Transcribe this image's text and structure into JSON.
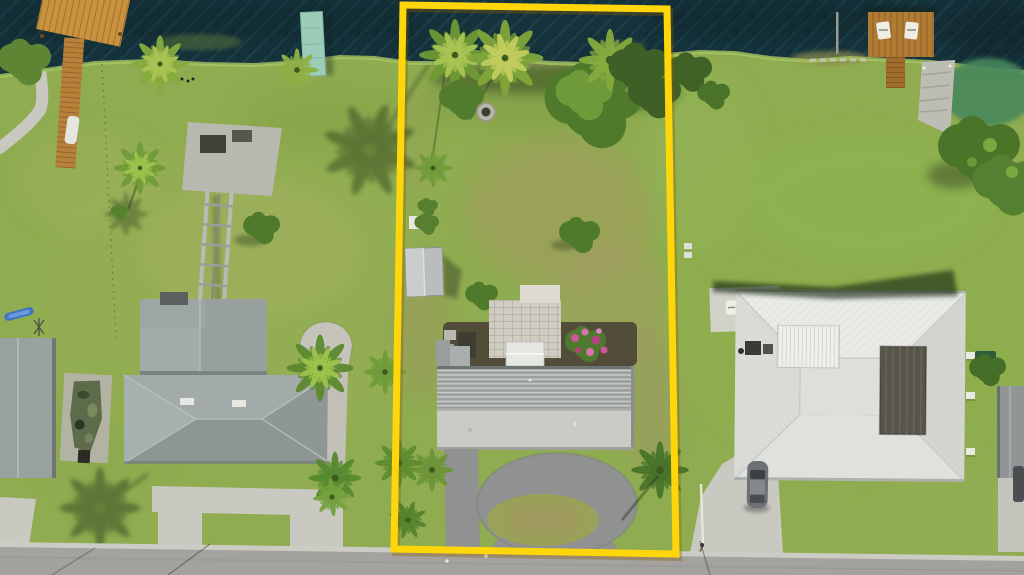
{
  "scene": {
    "kind": "aerial-drone-photograph",
    "subject": "waterfront-lot-with-yellow-property-outline",
    "water_edge": "canal across top",
    "street_edge": "asphalt road across bottom"
  },
  "colors": {
    "lot_outline": "#FFD60A",
    "lot_outline_shadow": "#8A5C00",
    "water": "#16333C",
    "grass_base": "#8FAC50",
    "road_asphalt": "#A3A29E",
    "gutter_concrete": "#CDCCC4",
    "concrete": "#CAC9C1",
    "driveway_asphalt": "#8F9290",
    "roof_left_house": "#98A09F",
    "roof_center_ribbed": "#A3A8A6",
    "roof_center_smooth": "#C8CAC5",
    "roof_right_house": "#DDDFDB",
    "lanai_courtyard": "#57544A",
    "dock_wood": "#B07B33",
    "dock_teal": "#9CCDB9",
    "flower_pink": "#C9579A",
    "car_gray": "#6E7173",
    "boat_camo": "#5D6B4A",
    "tree_dark": "#3E5F26",
    "palm_bright": "#7FA63A",
    "shadow_green": "#2A3F1C",
    "dirt": "#A89B68"
  },
  "objects": {
    "water": "canal water",
    "left_dock": "orange wooden dock",
    "teal_dock": "teal floating dock",
    "boat_lift": "boat lift rails and concrete pad",
    "lot": "vacant-style waterfront lot outlined in yellow",
    "lot_palms": "palm trees along lot shoreline",
    "fire_pit": "fire pit ring",
    "shed": "gray storage shed",
    "paver_patio": "paver patio",
    "flowers": "pink flowering shrub",
    "center_house": "manufactured home with ribbed metal roof",
    "loop_driveway": "asphalt loop driveway with grass island",
    "left_house": "left neighbor house with gray hip roof",
    "boat": "camouflage boat on pad",
    "right_house": "right neighbor house with white roof and screened courtyard",
    "right_dock": "wooden dock with two chairs",
    "car": "parked gray car",
    "road": "residential street"
  }
}
